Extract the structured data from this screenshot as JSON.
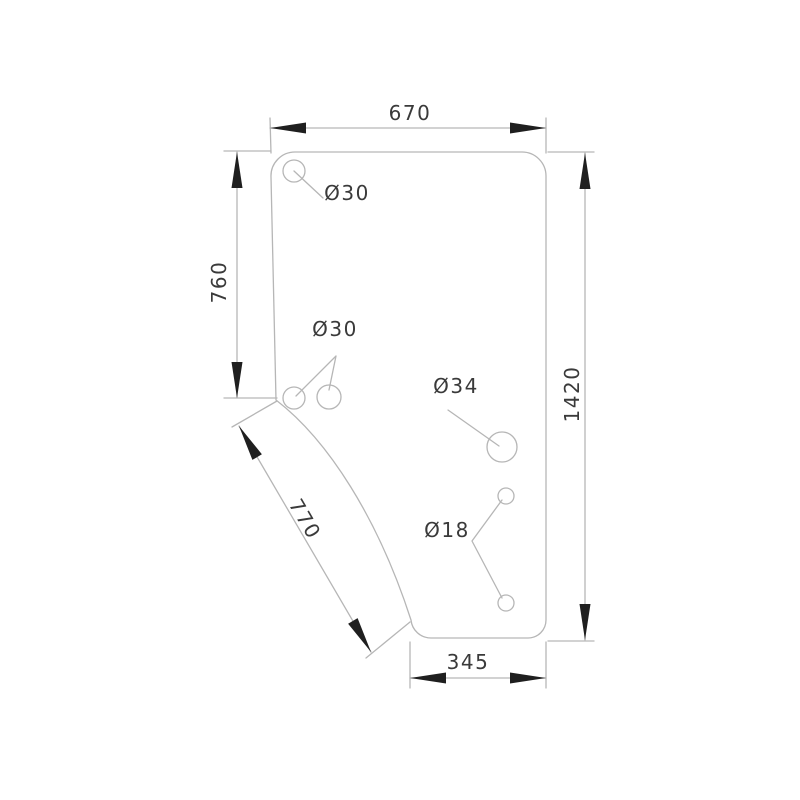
{
  "drawing": {
    "dimensions": {
      "top_width": "670",
      "left_height": "760",
      "right_height": "1420",
      "diagonal_edge": "770",
      "bottom_width": "345"
    },
    "holes": {
      "top_corner": "Ø30",
      "middle_pair": "Ø30",
      "large": "Ø34",
      "small_pair": "Ø18"
    },
    "colors": {
      "background": "#ffffff",
      "line": "#b6b6b6",
      "arrow": "#1f1f1f",
      "text": "#3a3a3a"
    }
  }
}
